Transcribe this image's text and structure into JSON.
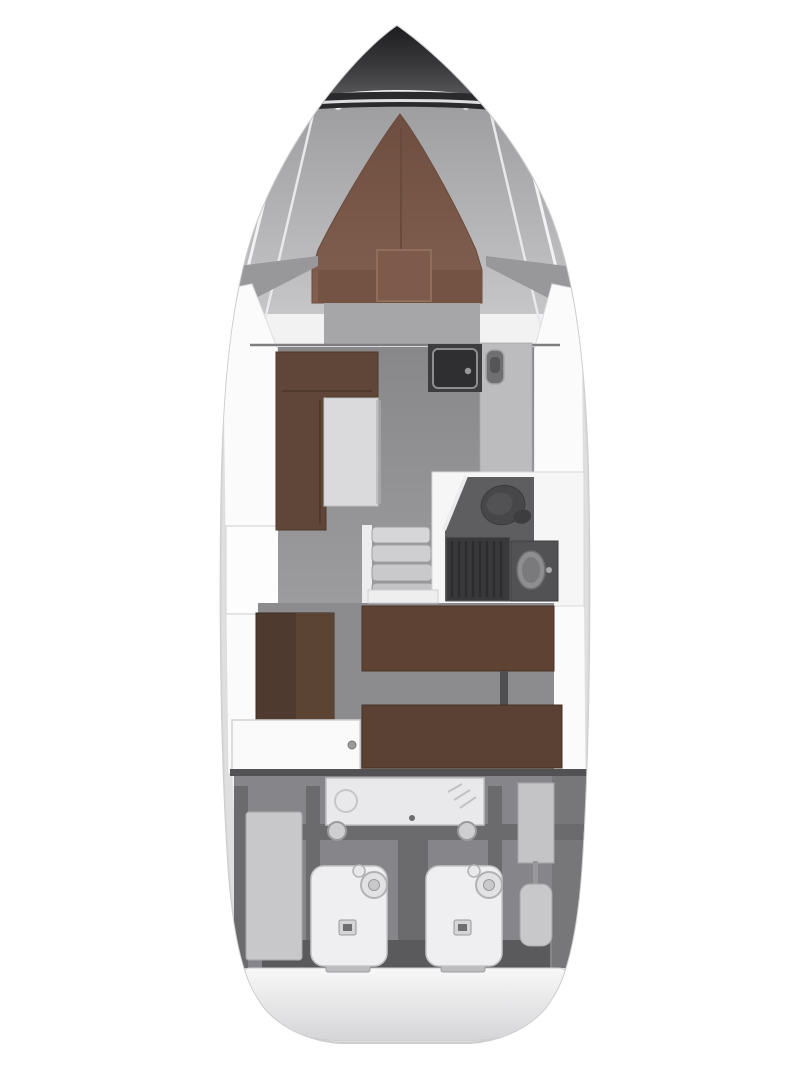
{
  "canvas": {
    "width": 810,
    "height": 1080,
    "background": "#ffffff"
  },
  "diagram": {
    "type": "yacht-deck-floorplan",
    "orientation": "bow-up",
    "colors": {
      "hull": "#f2f2f3",
      "hull_edge": "#cdcdcf",
      "nose_dark": "#2a2a2c",
      "foredeck_gray": "#b0b0b2",
      "v_berth_brown": "#7d5a4b",
      "headboard_brown": "#745244",
      "sofa_brown": "#5f4638",
      "wardrobe_brown": "#4e3a2e",
      "wardrobe_brown_light": "#5c4435",
      "aft_berth_upper": "#5e4334",
      "aft_berth_lower": "#5b4133",
      "salon_floor": "#919193",
      "foot_floor": "#a6a6a8",
      "aft_floor": "#8c8c8e",
      "engine_floor": "#86868a",
      "beam_gray": "#6b6b6d",
      "bathroom_floor": "#5e5e60",
      "shower_dark": "#39393b",
      "toilet_gray": "#47474a",
      "vanity_gray": "#525254",
      "vanity_sink": "#8e8e90",
      "galley_counter_dark": "#3d3d3f",
      "galley_sink": "#2f2f31",
      "galley_counter_light": "#bcbcbe",
      "fixture_gray": "#6f6f71",
      "table_gray": "#dadadc",
      "stair_tread": "#c9c9cb",
      "tank_gray": "#c8c8ca",
      "generator_white": "#e9e9eb",
      "engine_white": "#efeff1",
      "door_white": "#fafafb",
      "side_deck_white": "#fbfbfc",
      "platform_white": "#f6f6f7",
      "stern_wall": "#5a5a5c"
    },
    "regions": [
      {
        "id": "anchor-locker",
        "label": "bow anchor locker"
      },
      {
        "id": "foredeck",
        "label": "foredeck side panels"
      },
      {
        "id": "forward-cabin",
        "label": "forward cabin V-berth"
      },
      {
        "id": "salon",
        "label": "salon with L-shaped sofa and table"
      },
      {
        "id": "galley",
        "label": "galley counter with sink"
      },
      {
        "id": "companionway",
        "label": "companionway stairs"
      },
      {
        "id": "head",
        "label": "bathroom with toilet, shower and vanity"
      },
      {
        "id": "aft-cabin",
        "label": "aft cabin with twin berths and wardrobe"
      },
      {
        "id": "engine-room",
        "label": "engine room with twin engines, generator and tanks"
      },
      {
        "id": "swim-platform",
        "label": "stern swim platform"
      }
    ]
  }
}
